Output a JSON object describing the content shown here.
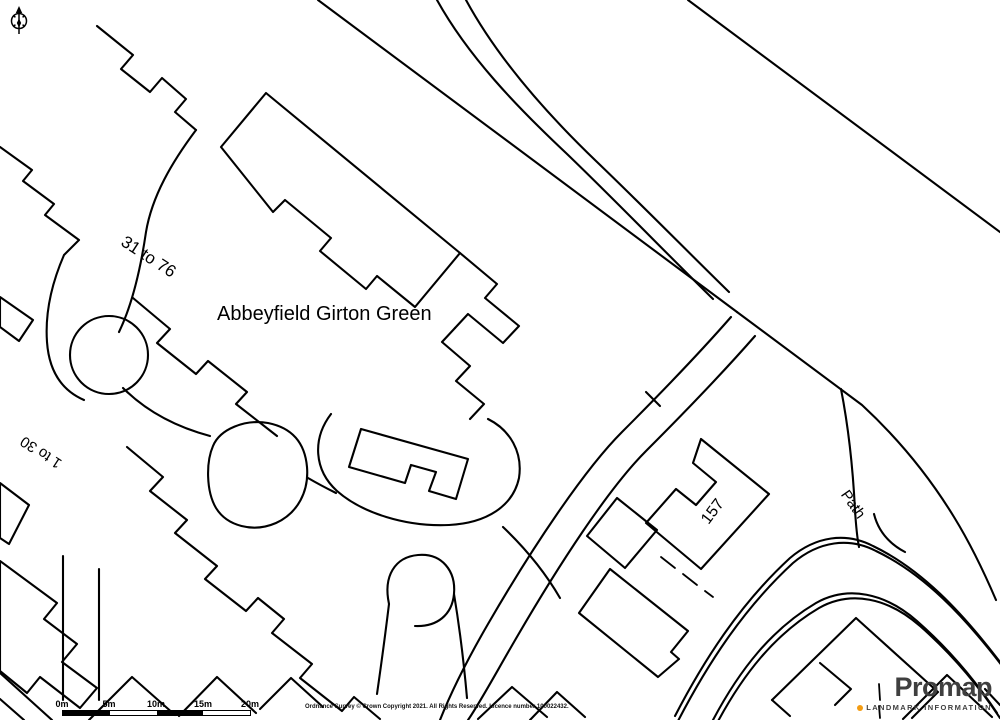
{
  "map_labels": {
    "block_31_76": "31 to 76",
    "site_name": "Abbeyfield Girton Green",
    "block_1_30": "1 to 30",
    "house_157": "157",
    "path": "Path"
  },
  "scale_bar": {
    "labels": [
      "0m",
      "5m",
      "10m",
      "15m",
      "20m"
    ]
  },
  "attribution": "Ordnance Survey © Crown Copyright 2021. All Rights Reserved. Licence number 100022432.",
  "branding": {
    "name": "Promap",
    "tagline": "LANDMARK INFORMATION"
  },
  "icons": {
    "north_arrow": "compass-north-icon",
    "landmark_dot": "orange-dot-icon"
  },
  "colors": {
    "map_line": "#000000",
    "background": "#ffffff",
    "brand_text": "#3f3f3f",
    "brand_dot": "#f39c12"
  }
}
